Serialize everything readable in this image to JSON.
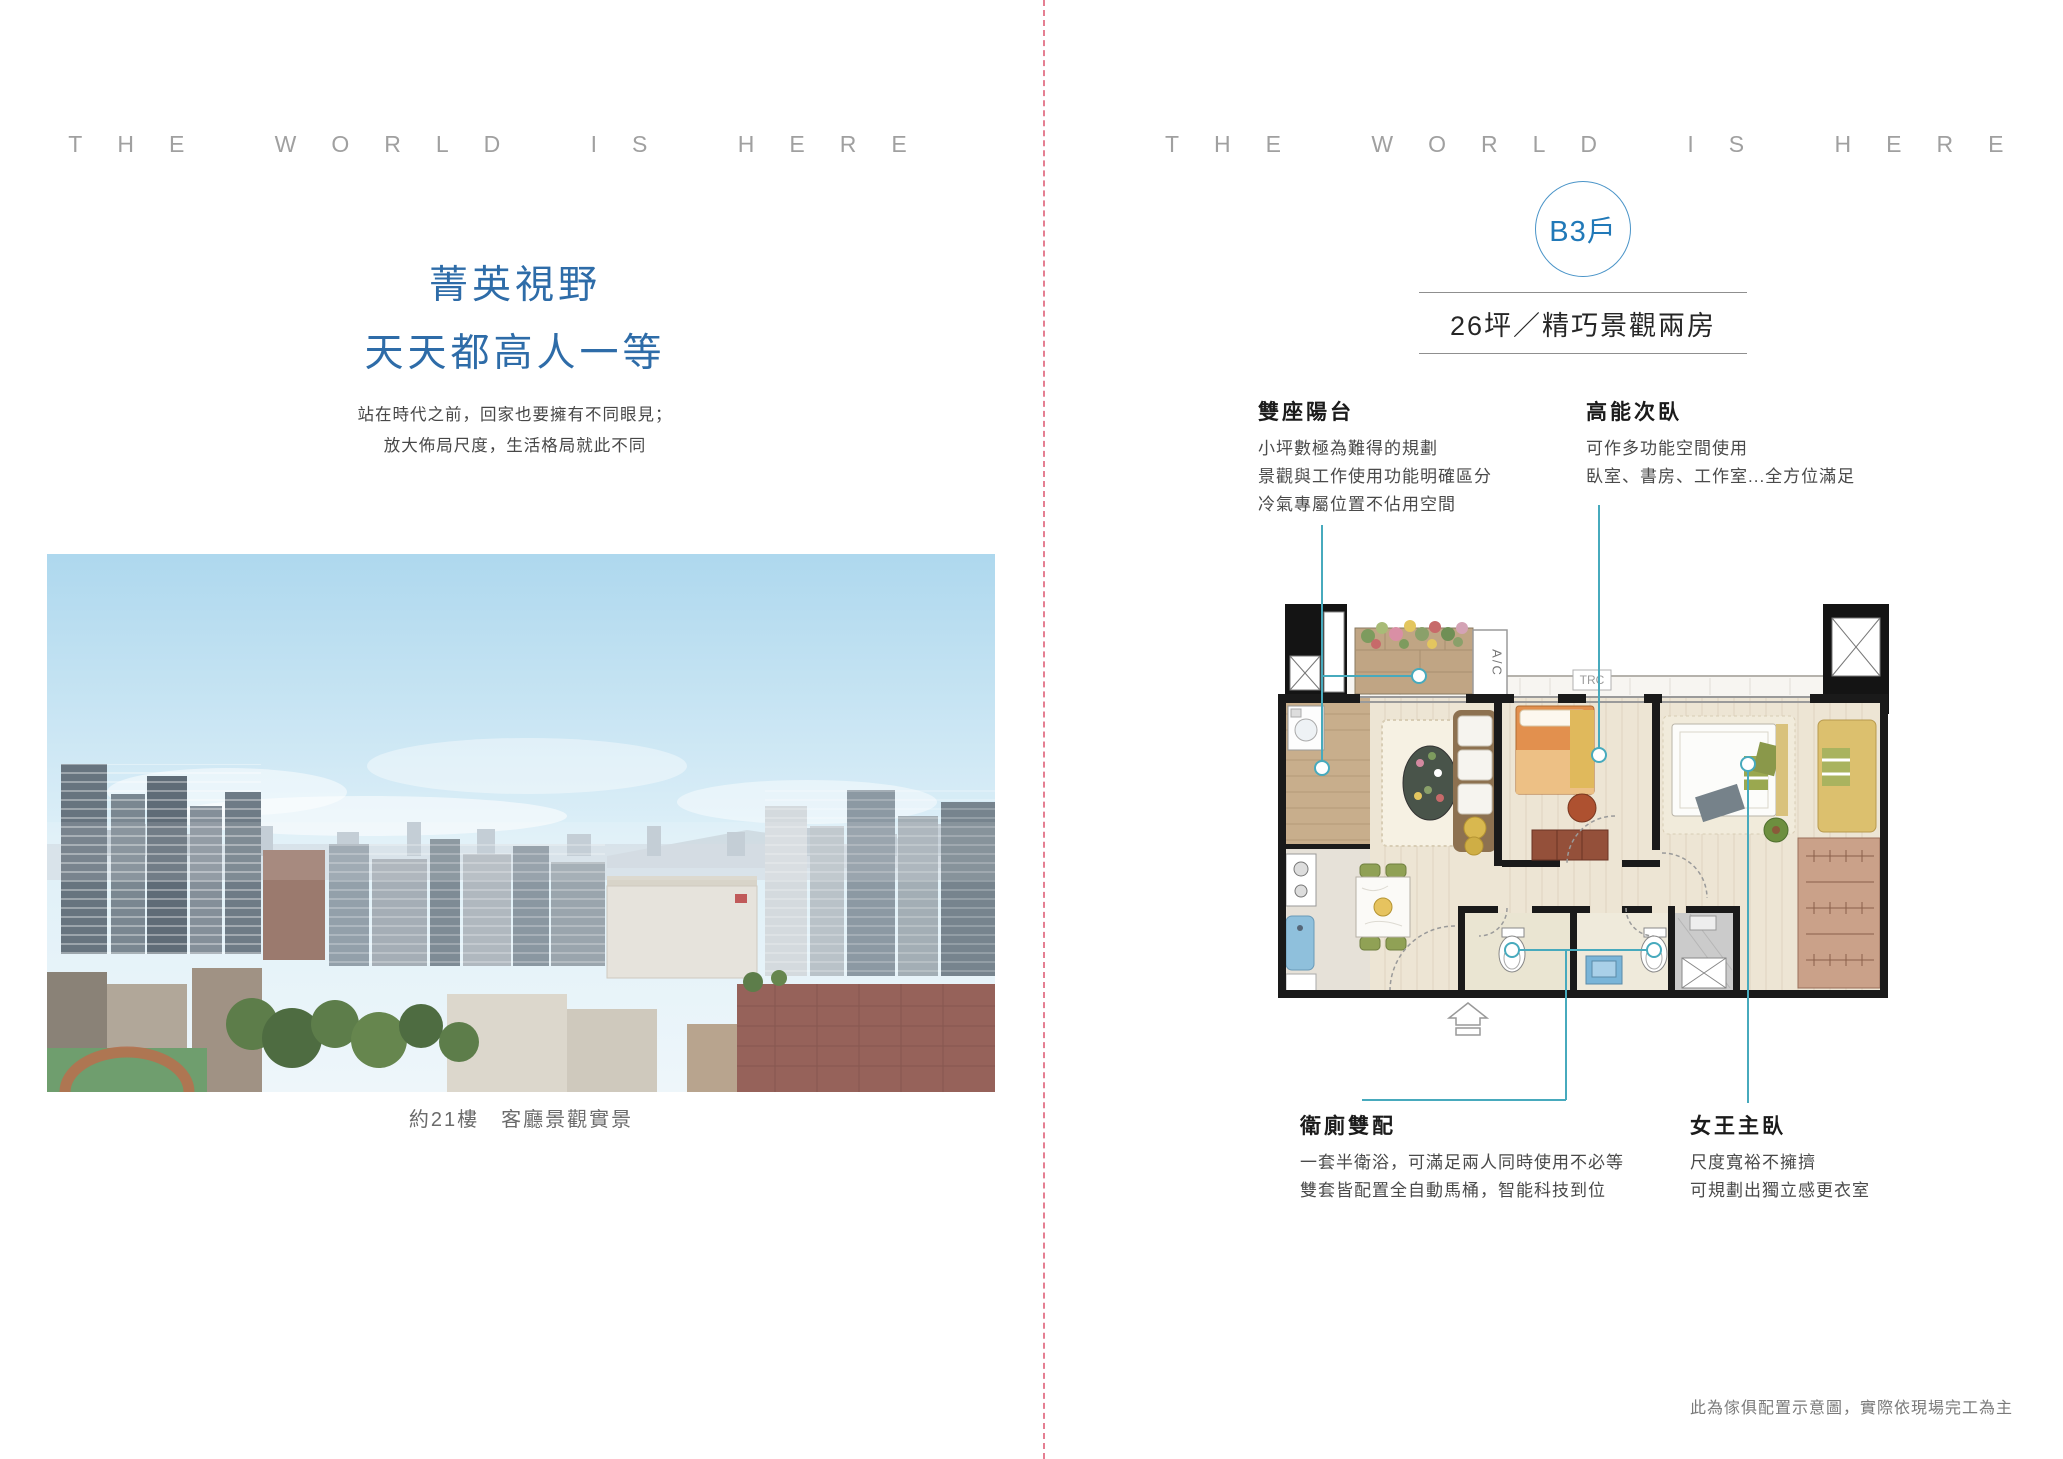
{
  "brand_header": {
    "left": "THE WORLD IS HERE",
    "right": "THE WORLD IS HERE"
  },
  "left_page": {
    "title_line1": "菁英視野",
    "title_line2": "天天都高人一等",
    "subtitle_line1": "站在時代之前，回家也要擁有不同眼見；",
    "subtitle_line2": "放大佈局尺度，生活格局就此不同",
    "photo_caption": "約21樓　客廳景觀實景"
  },
  "right_page": {
    "unit_badge": "B3戶",
    "unit_title": "26坪／精巧景觀兩房",
    "annotations": [
      {
        "title": "雙座陽台",
        "lines": [
          "小坪數極為難得的規劃",
          "景觀與工作使用功能明確區分",
          "冷氣專屬位置不佔用空間"
        ]
      },
      {
        "title": "高能次臥",
        "lines": [
          "可作多功能空間使用",
          "臥室、書房、工作室...全方位滿足"
        ]
      },
      {
        "title": "衛廁雙配",
        "lines": [
          "一套半衛浴，可滿足兩人同時使用不必等",
          "雙套皆配置全自動馬桶，智能科技到位"
        ]
      },
      {
        "title": "女王主臥",
        "lines": [
          "尺度寬裕不擁擠",
          "可規劃出獨立感更衣室"
        ]
      }
    ],
    "floorplan": {
      "ac_label": "A/C",
      "trc_label": "TRC"
    },
    "disclaimer": "此為傢俱配置示意圖，實際依現場完工為主"
  },
  "colors": {
    "title_blue": "#2e6ca8",
    "badge_blue": "#2179b8",
    "leader_teal": "#47aabd",
    "divider_pink": "#e57f92",
    "header_gray": "#a0a0a0"
  }
}
